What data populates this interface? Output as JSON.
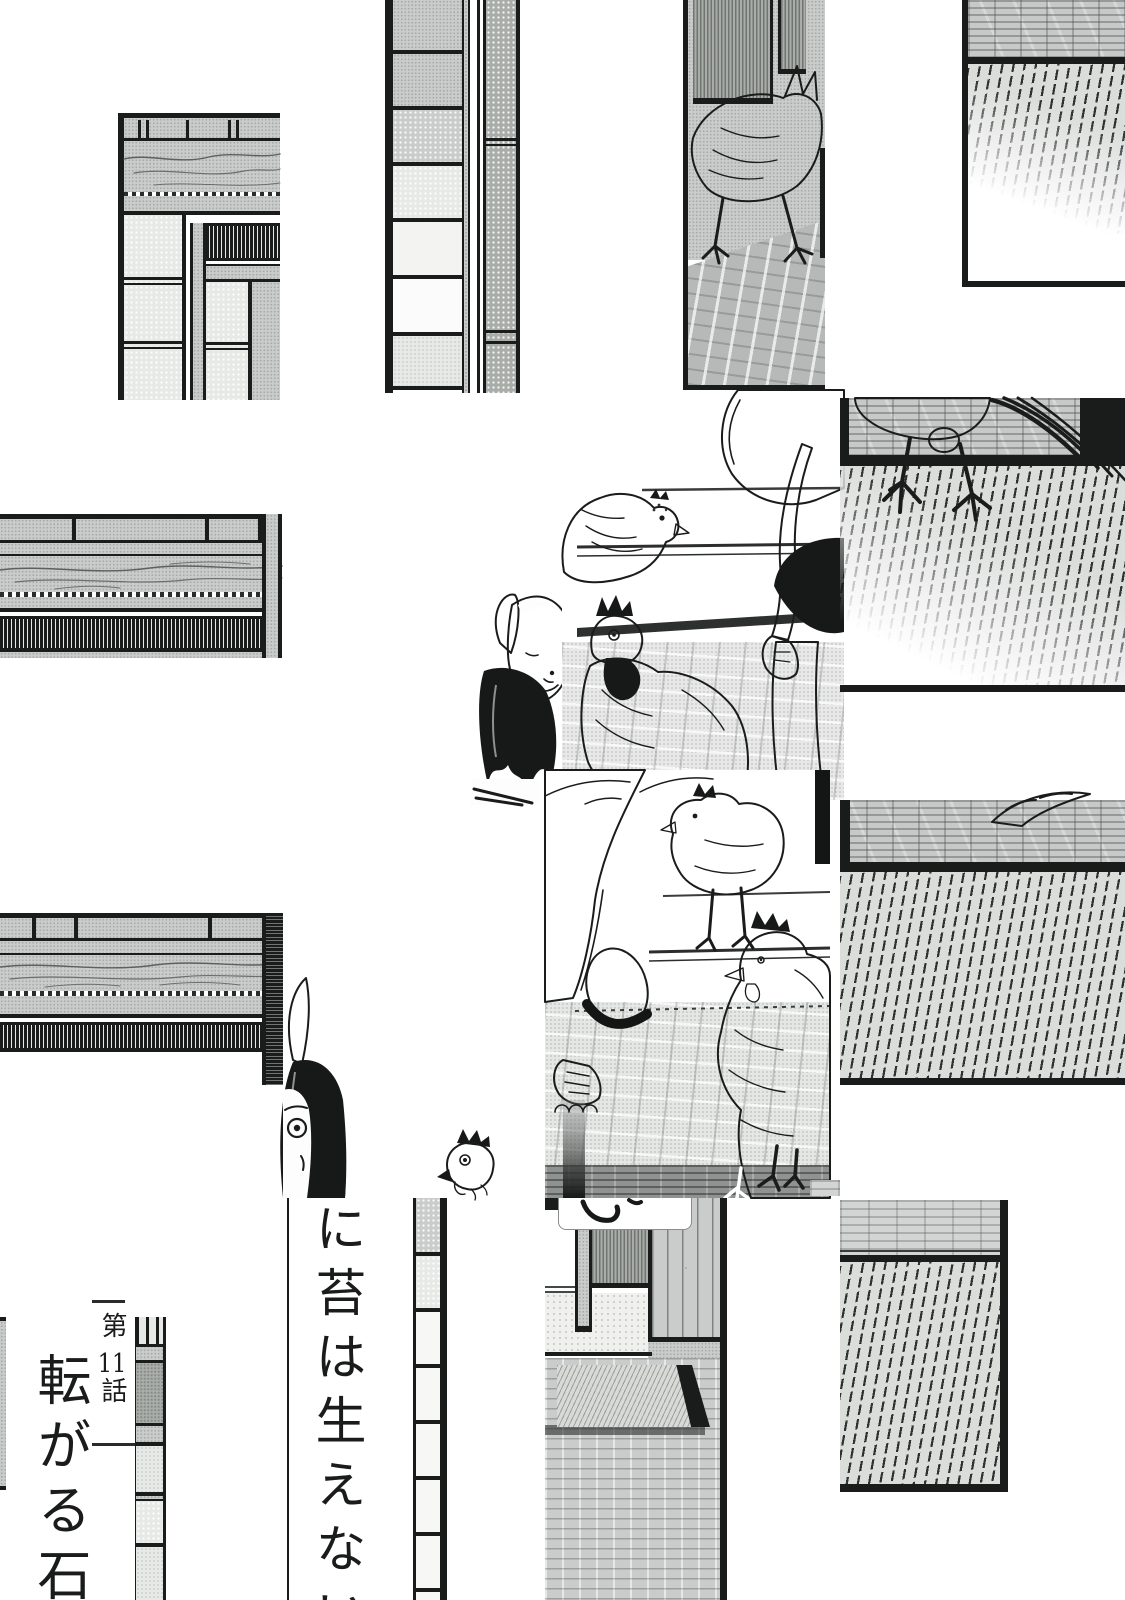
{
  "page": {
    "type": "manga-page",
    "proverb_vertical_text": "に苔は生えない",
    "chapter": {
      "prefix": "第",
      "number": "11",
      "suffix": "話",
      "title": "転がる石"
    }
  },
  "colors": {
    "paper": "#ffffff",
    "ink": "#1a1c1b",
    "tone_mid": "#c9ccca",
    "tone_dark": "#a9adaa",
    "tone_light": "#e7e9e7"
  }
}
